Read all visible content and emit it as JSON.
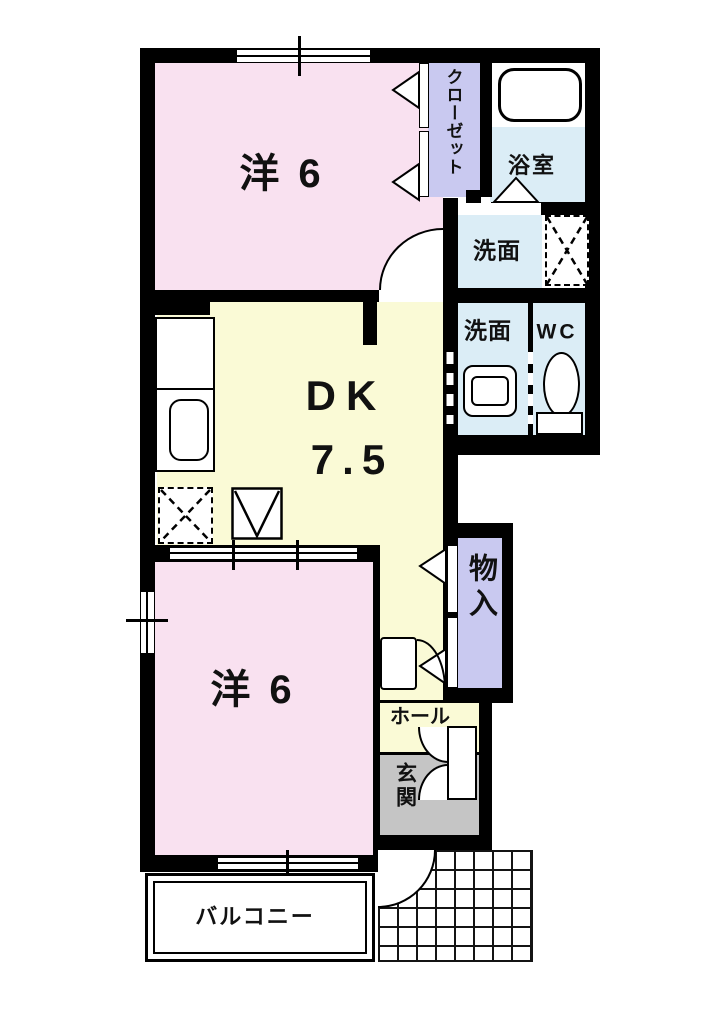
{
  "colors": {
    "wall": "#000000",
    "room_pink": "#F9E1F0",
    "room_yellow": "#FAFAD6",
    "room_lavender": "#C9C9F0",
    "room_blue": "#DBEDF6",
    "room_gray": "#C5C5C5",
    "label_text": "#111111"
  },
  "rooms": {
    "western_top": {
      "label": "洋 6"
    },
    "closet": {
      "label": "クローゼット"
    },
    "bath": {
      "label": "浴室"
    },
    "washroom_upper": {
      "label": "洗面"
    },
    "washroom_lower": {
      "label": "洗面"
    },
    "toilet": {
      "label": "WC"
    },
    "dining_kitchen": {
      "label": "DK",
      "area": "7.5"
    },
    "storage": {
      "label": "物入"
    },
    "hall": {
      "label": "ホール"
    },
    "entrance": {
      "label": "玄関"
    },
    "western_bottom": {
      "label": "洋 6"
    },
    "balcony": {
      "label": "バルコニー"
    }
  },
  "fixtures": [
    {
      "name": "bathtub-icon"
    },
    {
      "name": "bath-folding-door-icon"
    },
    {
      "name": "washing-machine-space-icon"
    },
    {
      "name": "washbasin-icon"
    },
    {
      "name": "toilet-icon"
    },
    {
      "name": "kitchen-counter-icon"
    },
    {
      "name": "kitchen-sink-icon"
    },
    {
      "name": "refrigerator-space-icon"
    },
    {
      "name": "water-heater-icon"
    },
    {
      "name": "door-swing-icon"
    },
    {
      "name": "bifold-door-icon"
    },
    {
      "name": "window-icon"
    },
    {
      "name": "shoe-cabinet-icon"
    },
    {
      "name": "entrance-tile-grid"
    }
  ]
}
